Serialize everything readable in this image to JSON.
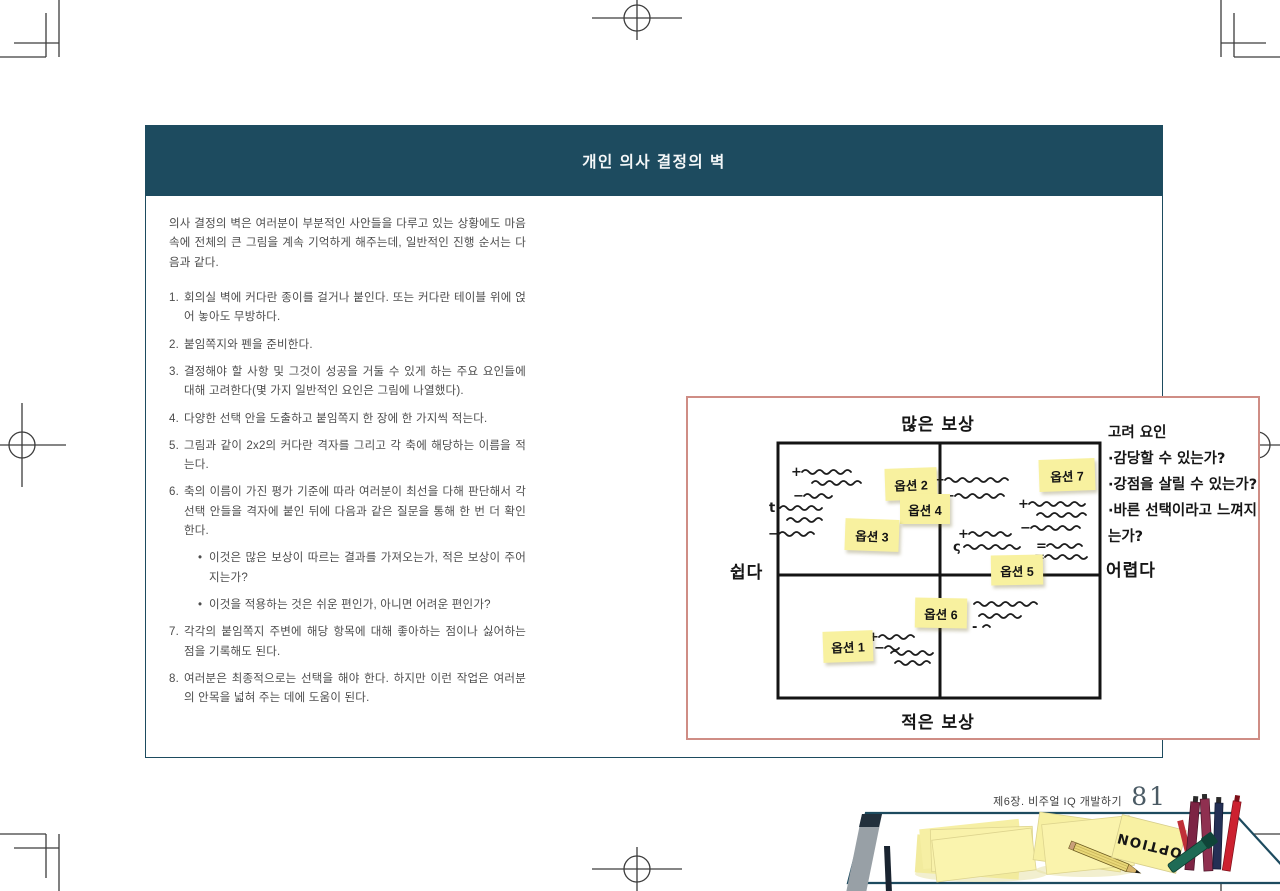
{
  "colors": {
    "header_bg": "#1d4b5f",
    "card_border": "#1d4b5f",
    "diagram_frame": "#cf8d85",
    "sticky_note": "#f8f19f",
    "grid_line": "#141414"
  },
  "card": {
    "header": {
      "title": "개인 의사 결정의 벽"
    },
    "intro": "의사 결정의 벽은 여러분이 부분적인 사안들을 다루고 있는 상황에도 마음속에 전체의 큰 그림을 계속 기억하게 해주는데, 일반적인 진행 순서는 다음과 같다.",
    "bullet_char": "•",
    "steps": [
      {
        "num": "1.",
        "text": "회의실 벽에 커다란 종이를 걸거나 붙인다. 또는 커다란 테이블 위에 얹어 놓아도 무방하다."
      },
      {
        "num": "2.",
        "text": "붙임쪽지와 펜을 준비한다."
      },
      {
        "num": "3.",
        "text": "결정해야 할 사항 및 그것이 성공을 거둘 수 있게 하는 주요 요인들에 대해 고려한다(몇 가지 일반적인 요인은 그림에 나열했다)."
      },
      {
        "num": "4.",
        "text": "다양한 선택 안을 도출하고 붙임쪽지 한 장에 한 가지씩 적는다."
      },
      {
        "num": "5.",
        "text": "그림과 같이 2x2의 커다란 격자를 그리고 각 축에 해당하는 이름을 적는다."
      },
      {
        "num": "6.",
        "text": "축의 이름이 가진 평가 기준에 따라 여러분이 최선을 다해 판단해서 각 선택 안들을 격자에 붙인 뒤에 다음과 같은 질문을 통해 한 번 더 확인한다.",
        "bullets": [
          "이것은 많은 보상이 따르는 결과를 가져오는가, 적은 보상이 주어지는가?",
          "이것을 적용하는 것은 쉬운 편인가, 아니면 어려운 편인가?"
        ]
      },
      {
        "num": "7.",
        "text": "각각의 붙임쪽지 주변에 해당 항목에 대해 좋아하는 점이나 싫어하는 점을 기록해도 된다."
      },
      {
        "num": "8.",
        "text": "여러분은 최종적으로는 선택을 해야 한다. 하지만 이런 작업은 여러분의 안목을 넓혀 주는 데에 도움이 된다."
      }
    ]
  },
  "diagram": {
    "axis": {
      "top": "많은 보상",
      "bottom": "적은 보상",
      "left": "쉽다",
      "right": "어렵다"
    },
    "considerations": {
      "title": "고려 요인",
      "items": [
        "·감당할 수 있는가?",
        "·강점을 살릴 수 있는가?",
        "·바른 선택이라고 느껴지는가?"
      ]
    },
    "notes": [
      {
        "label": "옵션 2",
        "x": 197,
        "y": 70,
        "w": 52,
        "h": 32,
        "r": -2
      },
      {
        "label": "옵션 4",
        "x": 212,
        "y": 96,
        "w": 50,
        "h": 30,
        "r": 0
      },
      {
        "label": "옵션 3",
        "x": 157,
        "y": 121,
        "w": 54,
        "h": 32,
        "r": 2
      },
      {
        "label": "옵션 7",
        "x": 351,
        "y": 61,
        "w": 56,
        "h": 32,
        "r": -2
      },
      {
        "label": "옵션 5",
        "x": 303,
        "y": 157,
        "w": 52,
        "h": 30,
        "r": -1
      },
      {
        "label": "옵션 6",
        "x": 227,
        "y": 200,
        "w": 52,
        "h": 30,
        "r": 1
      },
      {
        "label": "옵션 1",
        "x": 135,
        "y": 233,
        "w": 50,
        "h": 31,
        "r": -2
      }
    ],
    "scribbles": [
      {
        "s": "+",
        "x": 114,
        "y": 74,
        "l": 50
      },
      {
        "s": "",
        "x": 124,
        "y": 85,
        "l": 46
      },
      {
        "s": "−",
        "x": 116,
        "y": 98,
        "l": 30
      },
      {
        "s": "t",
        "x": 92,
        "y": 110,
        "l": 40
      },
      {
        "s": "",
        "x": 99,
        "y": 122,
        "l": 34
      },
      {
        "s": "−",
        "x": 91,
        "y": 136,
        "l": 38
      },
      {
        "s": "+",
        "x": 257,
        "y": 82,
        "l": 60
      },
      {
        "s": "−",
        "x": 267,
        "y": 98,
        "l": 46
      },
      {
        "s": "+",
        "x": 341,
        "y": 106,
        "l": 56
      },
      {
        "s": "",
        "x": 349,
        "y": 117,
        "l": 52
      },
      {
        "s": "−",
        "x": 343,
        "y": 130,
        "l": 50
      },
      {
        "s": "+",
        "x": 281,
        "y": 136,
        "l": 44
      },
      {
        "s": "ς",
        "x": 276,
        "y": 149,
        "l": 58
      },
      {
        "s": "=",
        "x": 359,
        "y": 148,
        "l": 36
      },
      {
        "s": "=",
        "x": 357,
        "y": 159,
        "l": 40
      },
      {
        "s": "·",
        "x": 286,
        "y": 206,
        "l": 62
      },
      {
        "s": "",
        "x": 291,
        "y": 218,
        "l": 42
      },
      {
        "s": "-",
        "x": 295,
        "y": 229,
        "l": 8
      },
      {
        "s": "+",
        "x": 191,
        "y": 239,
        "l": 36
      },
      {
        "s": "−",
        "x": 197,
        "y": 250,
        "l": 14
      },
      {
        "s": "",
        "x": 203,
        "y": 255,
        "l": 44
      },
      {
        "s": "",
        "x": 207,
        "y": 265,
        "l": 38
      }
    ]
  },
  "illustration": {
    "note_text": "OPTION"
  },
  "page": {
    "footer": {
      "chapter": "제6장. 비주얼 IQ 개발하기",
      "page_number": "81"
    }
  }
}
